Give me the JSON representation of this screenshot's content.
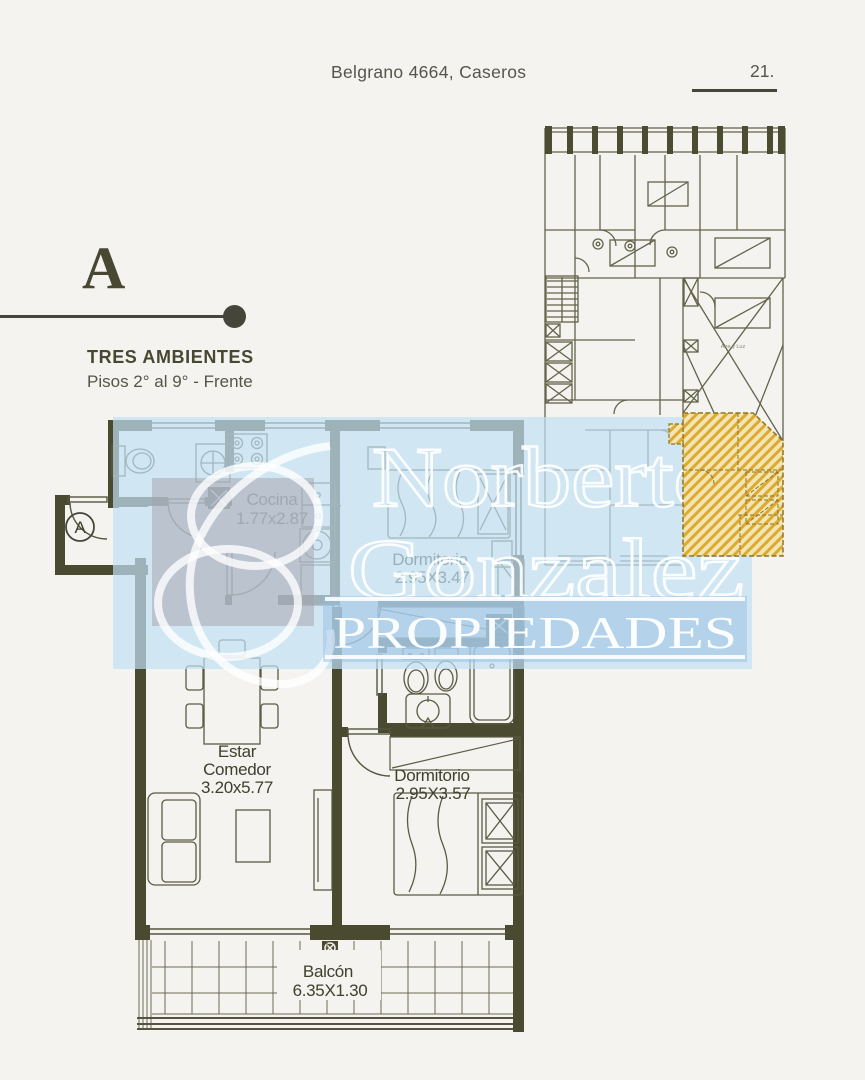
{
  "header": {
    "address": "Belgrano 4664, Caseros",
    "page_number": "21."
  },
  "unit_block": {
    "letter": "A",
    "title": "TRES AMBIENTES",
    "subtitle": "Pisos 2° al 9° - Frente"
  },
  "plan": {
    "entrance_label": "A",
    "rooms": {
      "cocina": {
        "name": "Cocina",
        "dims": "1.77x2.87"
      },
      "dormitorio1": {
        "name": "Dormitorio",
        "dims": "2.95X3.47"
      },
      "estar": {
        "name_line1": "Estar",
        "name_line2": "Comedor",
        "dims": "3.20x5.77"
      },
      "dormitorio2": {
        "name": "Dormitorio",
        "dims": "2.95X3.57"
      },
      "balcon": {
        "name": "Balcón",
        "dims": "6.35X1.30"
      }
    }
  },
  "keyplan": {
    "courtyard_label": "Aire y Luz"
  },
  "watermark": {
    "line1": "Norberto",
    "line2": "Gonzalez",
    "line3": "PROPIEDADES"
  },
  "colors": {
    "page_bg": "#f4f3ef",
    "wall": "#4a4a30",
    "thin_line": "#55553f",
    "label_text": "#3f3f2d",
    "watermark_blue": "#cde3f3",
    "watermark_band_blue": "#aecbe6",
    "highlight_yellow": "#dcab2e",
    "highlight_bg": "#f2e4b4"
  }
}
